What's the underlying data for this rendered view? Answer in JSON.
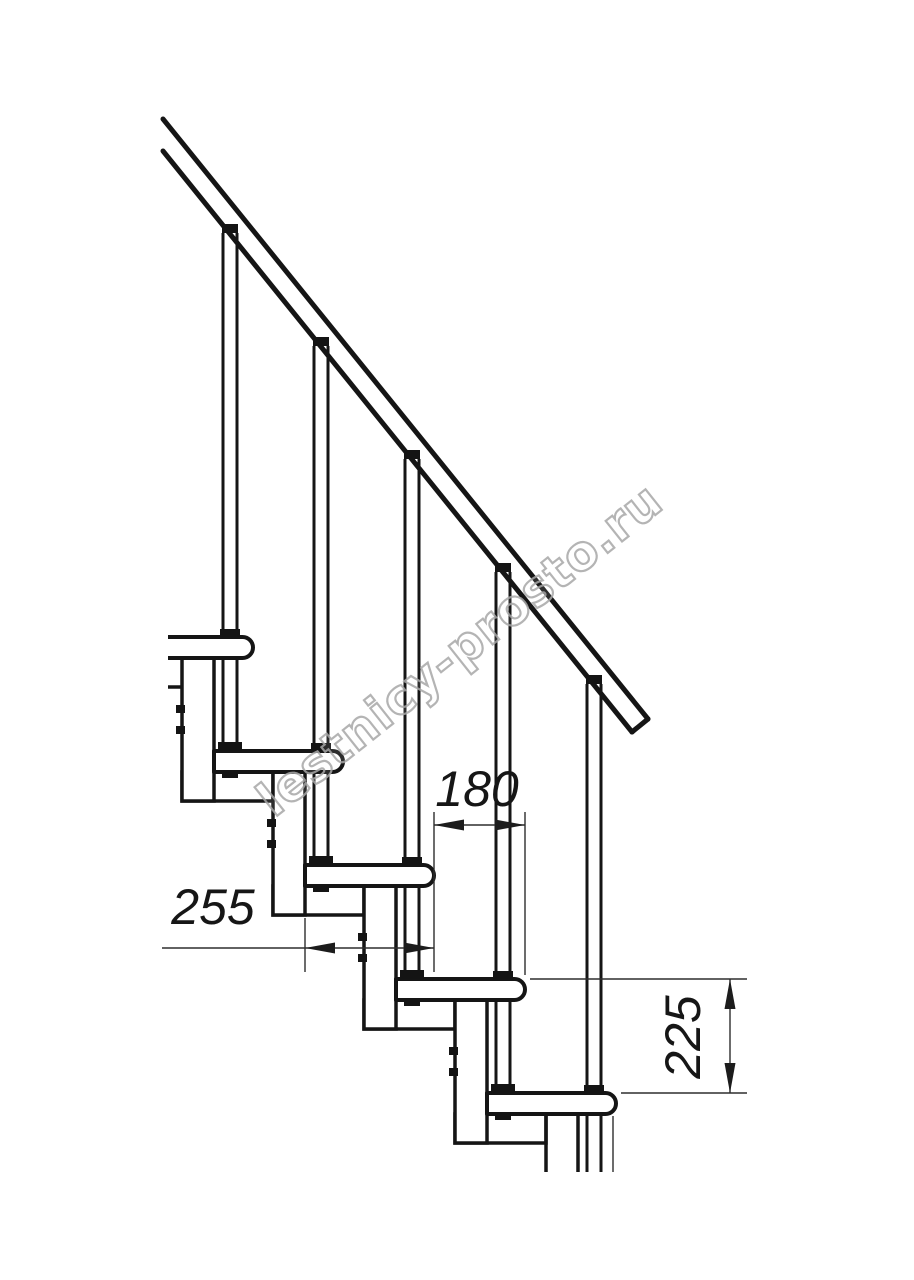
{
  "drawing": {
    "type": "modular-staircase-side-elevation",
    "background": "#ffffff",
    "line_color": "#151515",
    "thin_line_color": "#2e2e2e",
    "annotations": {
      "step_run": {
        "value": "180"
      },
      "tread_depth": {
        "value": "255"
      },
      "step_rise": {
        "value": "225"
      }
    },
    "watermark": {
      "text": "lestnicy-prosto.ru",
      "color": "#a8a8a8"
    }
  }
}
